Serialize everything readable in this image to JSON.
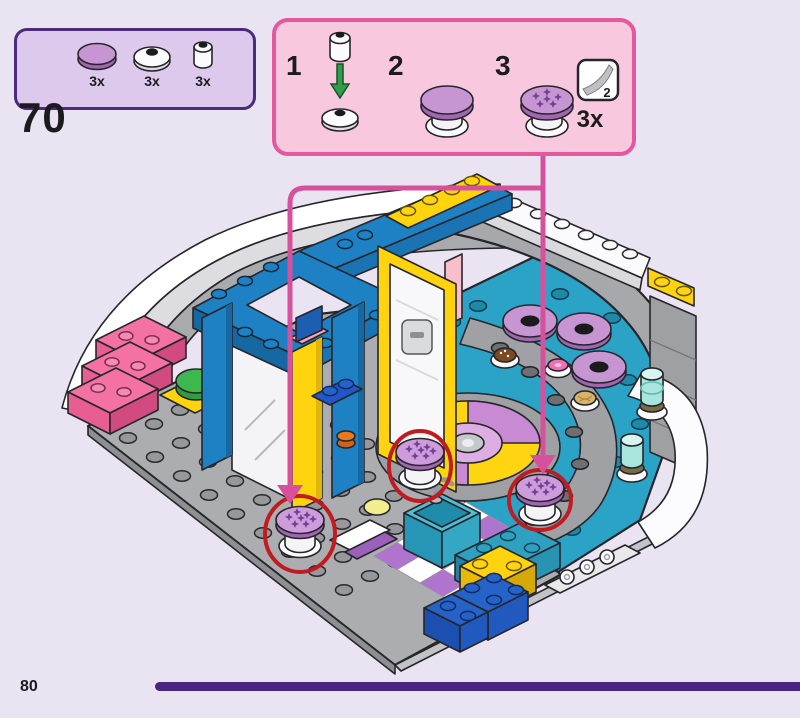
{
  "page": {
    "step_number": "70",
    "page_number": "80"
  },
  "colors": {
    "background": "#EAE3F2",
    "parts_box_border": "#4C2A7E",
    "parts_box_fill": "#DCC9EB",
    "substeps_border": "#E4589E",
    "substeps_fill": "#F8C8DF",
    "callout_line": "#D6509B",
    "highlight_circle": "#C11B22",
    "progress_bar": "#4A2480"
  },
  "parts_callout": {
    "parts": [
      {
        "icon": "round-tile-purple",
        "count": "3x"
      },
      {
        "icon": "round-plate-white-stud",
        "count": "3x"
      },
      {
        "icon": "round-brick-white",
        "count": "3x"
      }
    ]
  },
  "substeps_panel": {
    "steps": [
      {
        "number": "1"
      },
      {
        "number": "2"
      },
      {
        "number": "3"
      }
    ],
    "sticker": {
      "sheet_number": "2"
    },
    "quantity": "3x"
  }
}
